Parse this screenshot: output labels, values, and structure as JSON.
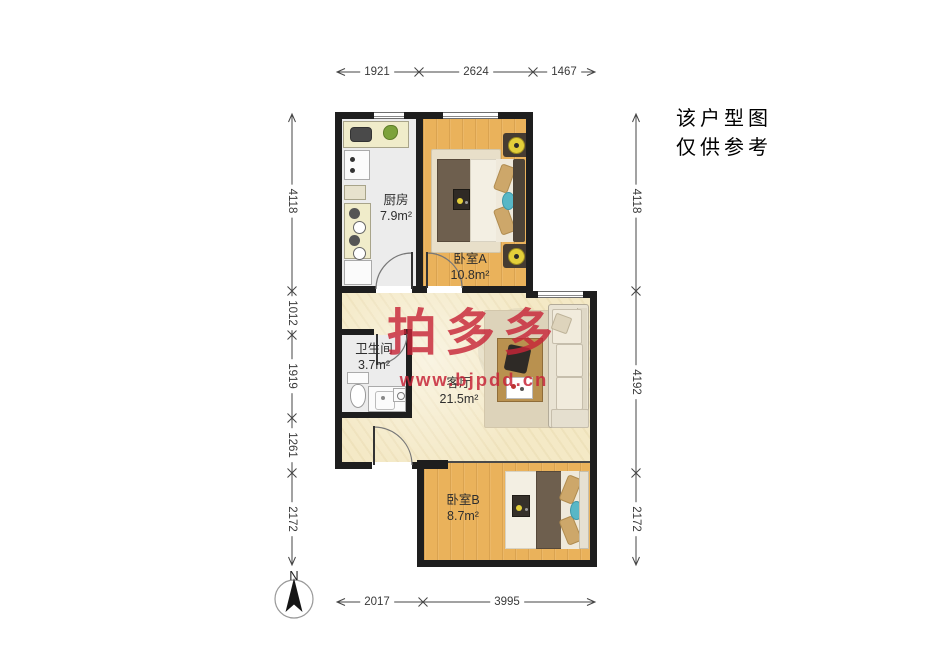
{
  "note": {
    "line1": "该户型图",
    "line2": "仅供参考"
  },
  "watermark": {
    "brand": "拍多多",
    "url": "www.bjpdd.cn"
  },
  "compass": {
    "north_label": "N"
  },
  "rooms": {
    "kitchen": {
      "name": "厨房",
      "area": "7.9m²"
    },
    "bedroomA": {
      "name": "卧室A",
      "area": "10.8m²"
    },
    "bathroom": {
      "name": "卫生间",
      "area": "3.7m²"
    },
    "living": {
      "name": "客厅",
      "area": "21.5m²"
    },
    "bedroomB": {
      "name": "卧室B",
      "area": "8.7m²"
    }
  },
  "dimensions": {
    "top": [
      "1921",
      "2624",
      "1467"
    ],
    "bottom": [
      "2017",
      "3995"
    ],
    "left": [
      "4118",
      "1012",
      "1919",
      "1261",
      "2172"
    ],
    "right": [
      "4118",
      "4192",
      "2172"
    ]
  },
  "colors": {
    "wall": "#1e1e1e",
    "wood_floor": "#eab25b",
    "living_floor": "#f4e9c6",
    "tile_floor": "#ececec",
    "watermark_red": "#c72638"
  }
}
